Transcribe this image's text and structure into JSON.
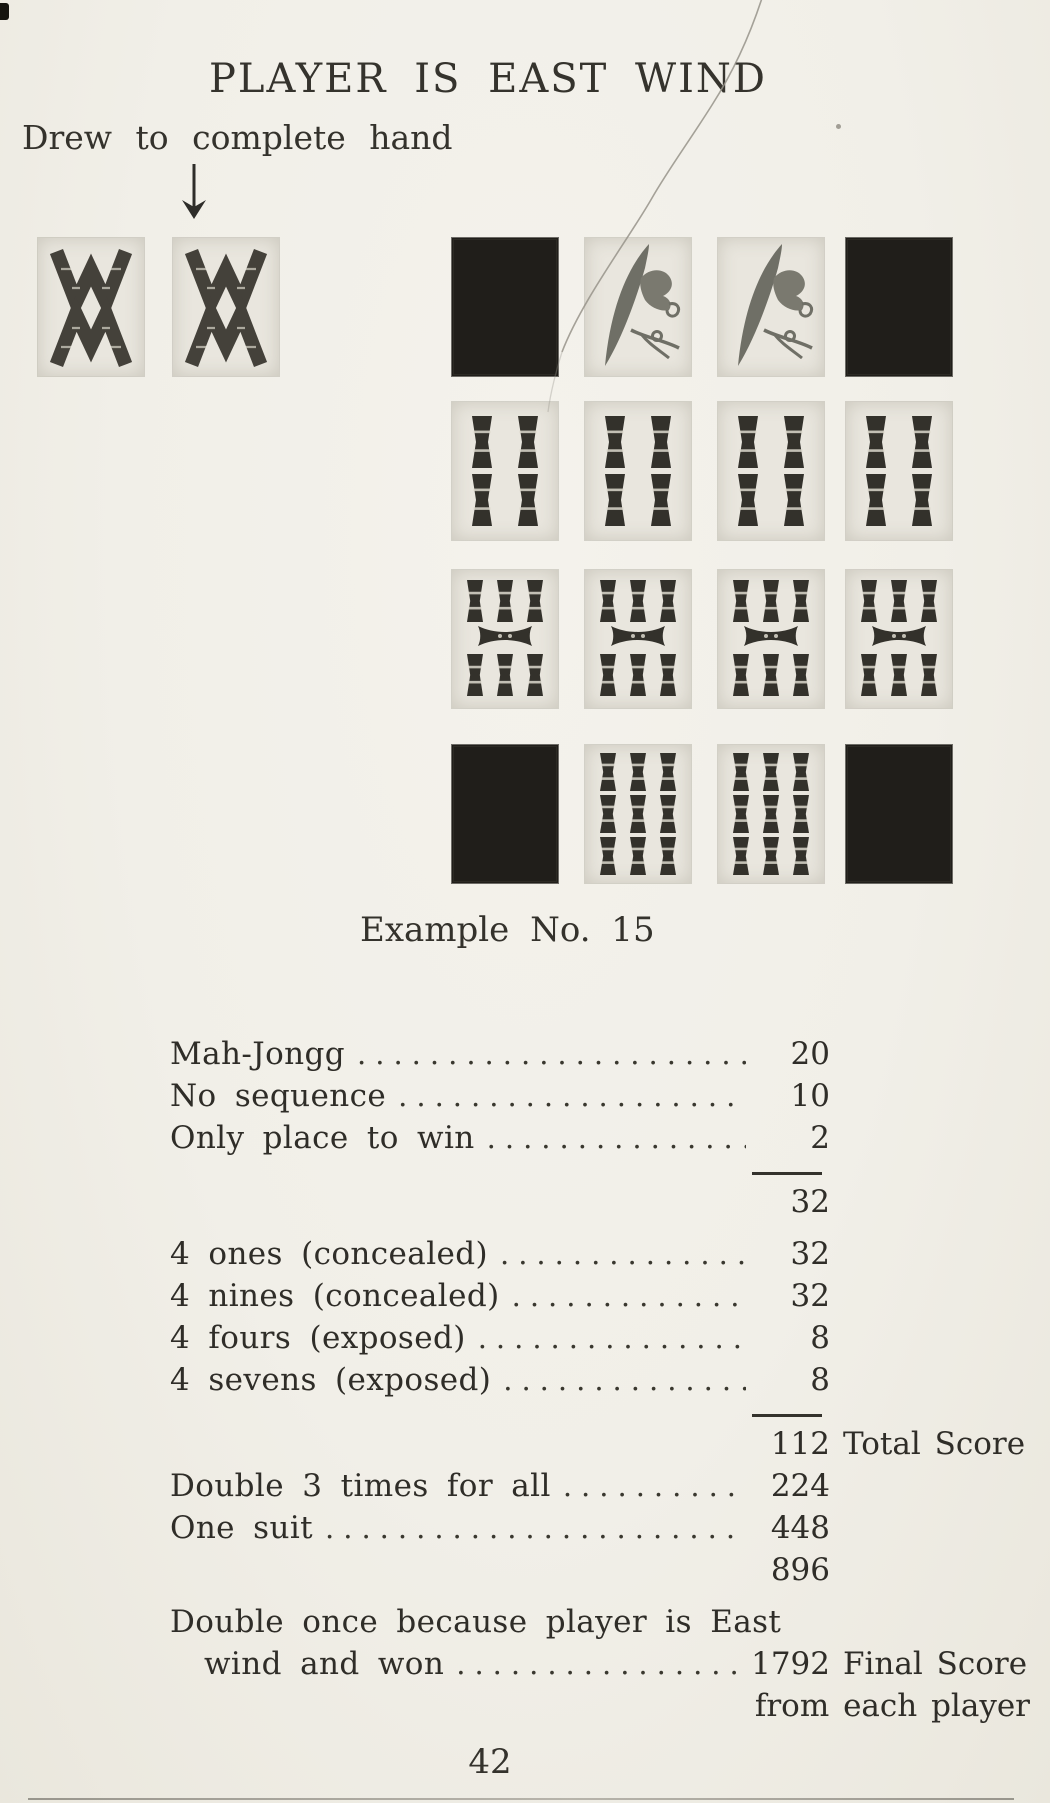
{
  "page": {
    "title": "PLAYER IS EAST WIND",
    "hand_annotation": "Drew to complete hand",
    "caption": "Example No. 15",
    "page_number": "42",
    "paper_color": "#f1efe8",
    "ink_color": "#2e2c27"
  },
  "tiles": {
    "pair_row": {
      "name": "pair-of-two-bamboo",
      "y": 238,
      "tiles": [
        {
          "type": "two-bamboo",
          "x": 38
        },
        {
          "type": "two-bamboo",
          "x": 173
        }
      ]
    },
    "meld_rows": [
      {
        "name": "kong-of-ones-concealed",
        "y": 238,
        "tiles": [
          {
            "type": "tile-back",
            "x": 452
          },
          {
            "type": "one-bamboo-bird",
            "x": 585
          },
          {
            "type": "one-bamboo-bird",
            "x": 718
          },
          {
            "type": "tile-back",
            "x": 846
          }
        ]
      },
      {
        "name": "kong-of-fours-exposed",
        "y": 402,
        "tiles": [
          {
            "type": "four-bamboo",
            "x": 452
          },
          {
            "type": "four-bamboo",
            "x": 585
          },
          {
            "type": "four-bamboo",
            "x": 718
          },
          {
            "type": "four-bamboo",
            "x": 846
          }
        ]
      },
      {
        "name": "kong-of-sevens-exposed",
        "y": 570,
        "tiles": [
          {
            "type": "seven-bamboo",
            "x": 452
          },
          {
            "type": "seven-bamboo",
            "x": 585
          },
          {
            "type": "seven-bamboo",
            "x": 718
          },
          {
            "type": "seven-bamboo",
            "x": 846
          }
        ]
      },
      {
        "name": "kong-of-nines-concealed",
        "y": 745,
        "tiles": [
          {
            "type": "tile-back",
            "x": 452
          },
          {
            "type": "nine-bamboo",
            "x": 585
          },
          {
            "type": "nine-bamboo",
            "x": 718
          },
          {
            "type": "tile-back",
            "x": 846
          }
        ]
      }
    ]
  },
  "scoring": {
    "rows": [
      {
        "type": "item",
        "label": "Mah-Jongg",
        "value": "20"
      },
      {
        "type": "item",
        "label": "No sequence",
        "value": "10"
      },
      {
        "type": "item",
        "label": "Only place to win",
        "value": "2"
      },
      {
        "type": "rule"
      },
      {
        "type": "subtotal",
        "value": "32"
      },
      {
        "type": "item",
        "label": "4 ones (concealed)",
        "value": "32",
        "gap": true
      },
      {
        "type": "item",
        "label": "4 nines (concealed)",
        "value": "32"
      },
      {
        "type": "item",
        "label": "4 fours (exposed)",
        "value": "8"
      },
      {
        "type": "item",
        "label": "4 sevens (exposed)",
        "value": "8"
      },
      {
        "type": "rule"
      },
      {
        "type": "subtotal",
        "value": "112",
        "note": "Total Score"
      },
      {
        "type": "item",
        "label": "Double 3 times for all",
        "value": "224"
      },
      {
        "type": "item",
        "label": "One suit",
        "value": "448"
      },
      {
        "type": "subtotal",
        "value": "896"
      },
      {
        "type": "text",
        "label": "Double once because player is East",
        "gap": true
      },
      {
        "type": "item",
        "label": "wind and won",
        "value": "1792",
        "note": "Final Score",
        "indent": true,
        "tight": true
      },
      {
        "type": "noteonly",
        "note": "from each player"
      }
    ]
  }
}
